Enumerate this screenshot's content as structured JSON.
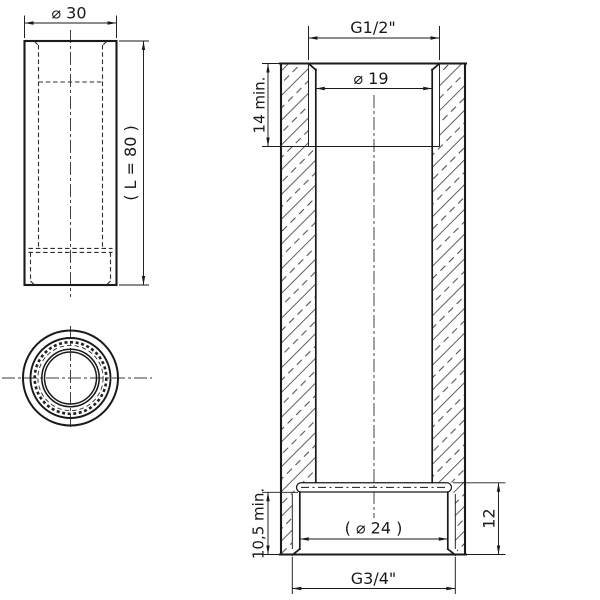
{
  "front_view": {
    "dim_diameter": "⌀ 30",
    "dim_length": "( L = 80 )"
  },
  "section_view": {
    "dim_thread_top": "G1/2\"",
    "dim_bore_top": "⌀ 19",
    "dim_depth_top": "14 min.",
    "dim_depth_bottom": "10,5 min.",
    "dim_bore_bottom": "( ⌀ 24 )",
    "dim_height_bottom": "12",
    "dim_thread_bottom": "G3/4\""
  },
  "colors": {
    "line": "#1a1a1a",
    "centerline": "#3a3a3a",
    "background": "#ffffff"
  }
}
